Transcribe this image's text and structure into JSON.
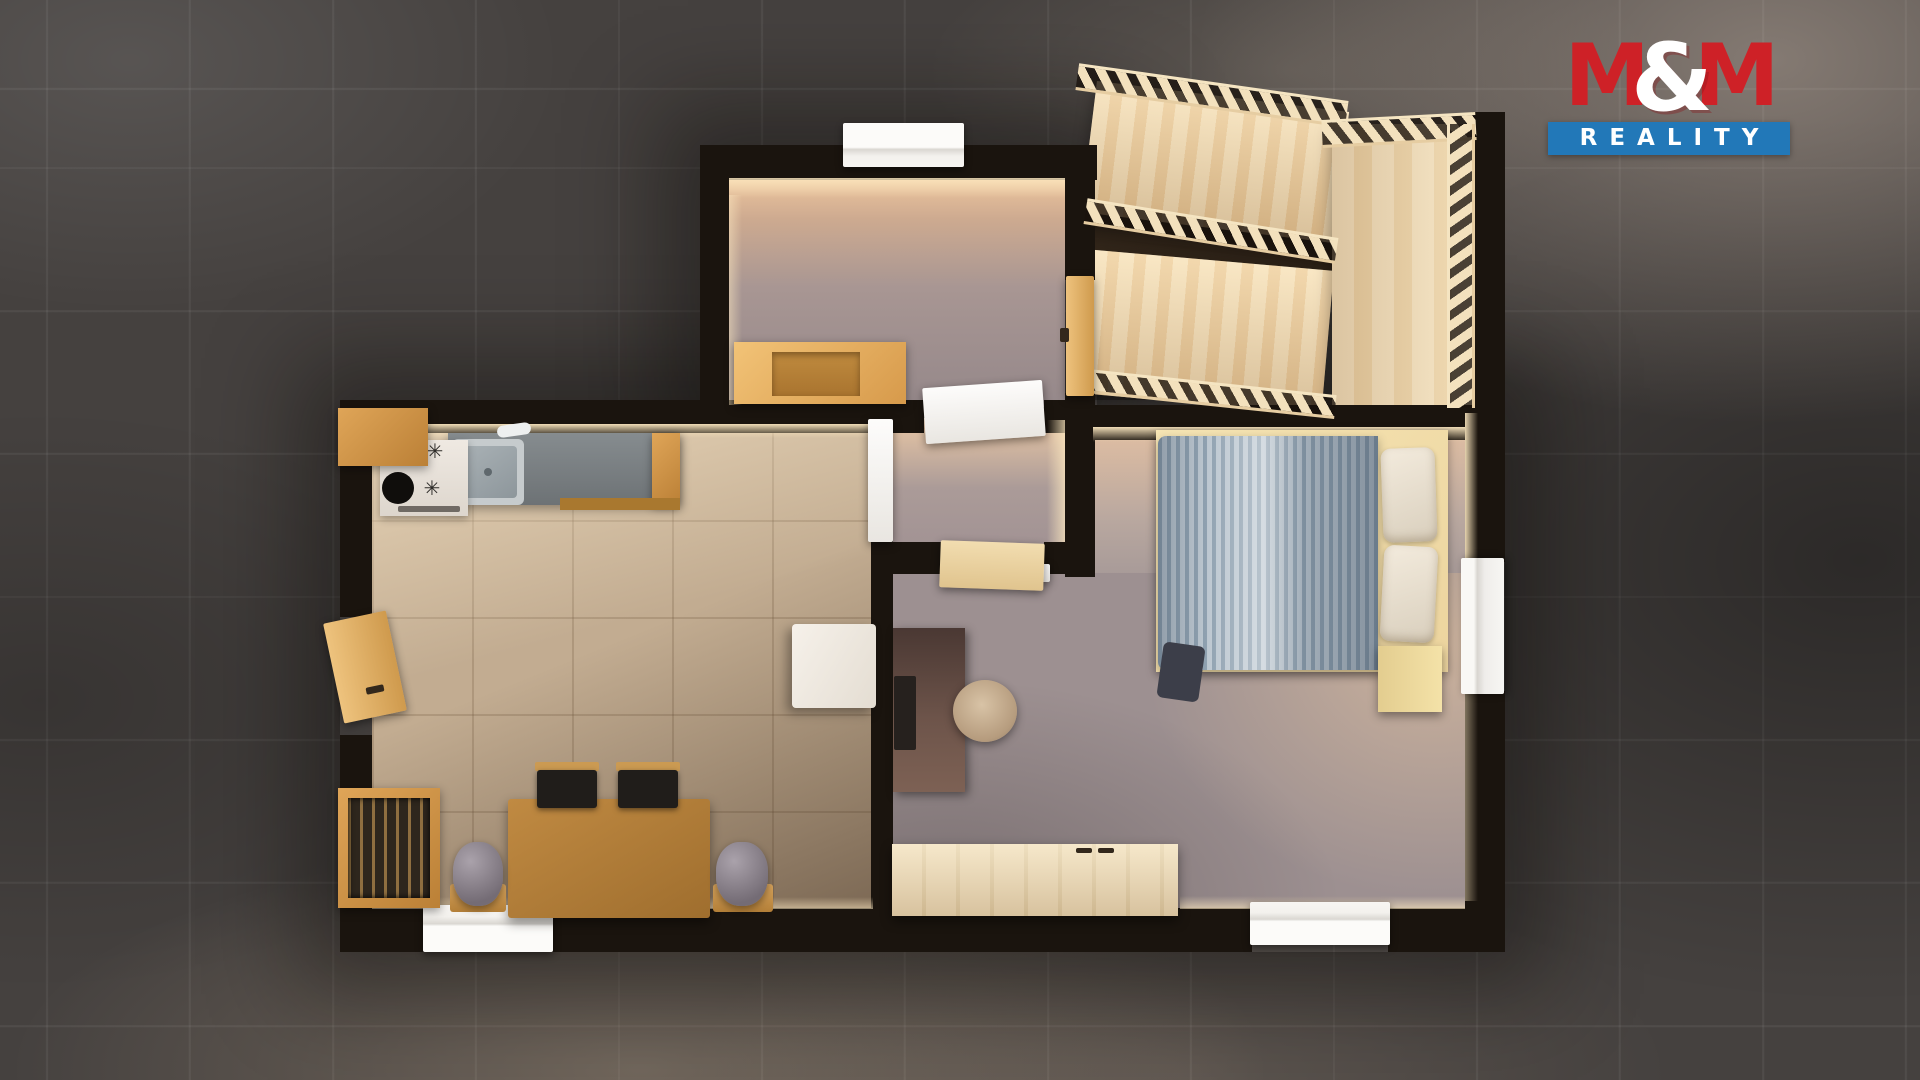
{
  "logo": {
    "m1": "M",
    "amp": "&",
    "m2": "M",
    "subtitle": "REALITY",
    "color_red": "#ce2127",
    "color_blue": "#2278b8",
    "text_color": "#ffffff"
  },
  "palette": {
    "background_tile": "#45413f",
    "wall": "#1a140e",
    "living_floor": "#c2ac91",
    "bedroom_floor": "#9d9091",
    "entry_floor": "#a89693",
    "stair_wood": "#f3e1bd",
    "furniture_wood": "#d79a4b",
    "duvet_blue": "#9fb0bd",
    "window_white": "#f7f5f2"
  },
  "scene": {
    "description": "3D top-down floor plan render: entry hall with bench, U-shaped staircase, kitchen-living room with dining set, hallway, bedroom with double bed, desk and sideboard",
    "items": [
      {
        "n": "shadow-halo-main",
        "c": "halo",
        "x": 340,
        "y": 400,
        "w": 1165,
        "h": 552
      },
      {
        "n": "shadow-halo-entry",
        "c": "halo",
        "x": 700,
        "y": 145,
        "w": 397,
        "h": 287
      },
      {
        "n": "entry-hall-floor",
        "c": "fl-entry",
        "x": 727,
        "y": 178,
        "w": 338,
        "h": 229
      },
      {
        "n": "living-room-floor",
        "c": "fl-living",
        "x": 372,
        "y": 432,
        "w": 501,
        "h": 478
      },
      {
        "n": "hallway-floor",
        "c": "fl-hall",
        "x": 893,
        "y": 418,
        "w": 172,
        "h": 127
      },
      {
        "n": "bedroom-floor-upper",
        "c": "fl-bed1",
        "x": 1093,
        "y": 438,
        "w": 372,
        "h": 140
      },
      {
        "n": "bedroom-floor-main",
        "c": "fl-bed2",
        "x": 893,
        "y": 573,
        "w": 572,
        "h": 337
      },
      {
        "n": "stair-gap-shadow",
        "c": "gapdark",
        "x": 1086,
        "y": 218,
        "w": 252,
        "h": 58,
        "r": 8
      },
      {
        "n": "stair-flight-upper",
        "c": "treads",
        "x": 1088,
        "y": 96,
        "w": 254,
        "h": 132,
        "r": 7
      },
      {
        "n": "stair-flight-lower",
        "c": "treads",
        "x": 1086,
        "y": 260,
        "w": 242,
        "h": 144,
        "r": 5
      },
      {
        "n": "stair-landing",
        "c": "treads2",
        "x": 1332,
        "y": 124,
        "w": 142,
        "h": 284
      },
      {
        "n": "wall-entry-top",
        "c": "wall",
        "x": 700,
        "y": 145,
        "w": 397,
        "h": 35
      },
      {
        "n": "wall-entry-left",
        "c": "wall",
        "x": 700,
        "y": 145,
        "w": 29,
        "h": 262
      },
      {
        "n": "wall-entry-right-upper",
        "c": "wall",
        "x": 1065,
        "y": 145,
        "w": 30,
        "h": 135
      },
      {
        "n": "wall-entry-right-lower",
        "c": "wall",
        "x": 1065,
        "y": 393,
        "w": 30,
        "h": 184
      },
      {
        "n": "wall-living-top-left",
        "c": "wall",
        "x": 340,
        "y": 400,
        "w": 584,
        "h": 33
      },
      {
        "n": "wall-living-top-right",
        "c": "wall",
        "x": 1044,
        "y": 400,
        "w": 33,
        "h": 33
      },
      {
        "n": "wall-bedroom-top",
        "c": "wall",
        "x": 1075,
        "y": 405,
        "w": 430,
        "h": 35
      },
      {
        "n": "wall-living-left-upper",
        "c": "wall",
        "x": 340,
        "y": 400,
        "w": 32,
        "h": 217
      },
      {
        "n": "wall-living-left-lower",
        "c": "wall",
        "x": 340,
        "y": 735,
        "w": 32,
        "h": 217
      },
      {
        "n": "wall-living-bottom-left",
        "c": "wall",
        "x": 340,
        "y": 908,
        "w": 85,
        "h": 44
      },
      {
        "n": "wall-living-bottom-right",
        "c": "wall",
        "x": 551,
        "y": 908,
        "w": 341,
        "h": 44
      },
      {
        "n": "wall-divider-top",
        "c": "wall",
        "x": 871,
        "y": 400,
        "w": 22,
        "h": 22
      },
      {
        "n": "wall-divider-lower",
        "c": "wall",
        "x": 871,
        "y": 540,
        "w": 22,
        "h": 368
      },
      {
        "n": "wall-hall-bottom-left",
        "c": "wall",
        "x": 893,
        "y": 542,
        "w": 49,
        "h": 32
      },
      {
        "n": "wall-hall-bottom-right",
        "c": "wall",
        "x": 1044,
        "y": 542,
        "w": 23,
        "h": 32
      },
      {
        "n": "wall-bedroom-right-upper",
        "c": "wall",
        "x": 1465,
        "y": 405,
        "w": 40,
        "h": 157
      },
      {
        "n": "wall-bedroom-right-lower",
        "c": "wall",
        "x": 1465,
        "y": 691,
        "w": 40,
        "h": 261
      },
      {
        "n": "wall-bedroom-bottom-left",
        "c": "wall",
        "x": 892,
        "y": 908,
        "w": 360,
        "h": 44
      },
      {
        "n": "wall-bedroom-bottom-right",
        "c": "wall",
        "x": 1388,
        "y": 908,
        "w": 117,
        "h": 44
      },
      {
        "n": "wall-staircase-right",
        "c": "wall",
        "x": 1472,
        "y": 112,
        "w": 33,
        "h": 296
      },
      {
        "n": "stair-railing-upper",
        "c": "rail",
        "x": 1076,
        "y": 82,
        "w": 272,
        "h": 27,
        "r": 8
      },
      {
        "n": "stair-railing-middle",
        "c": "rail",
        "x": 1084,
        "y": 218,
        "w": 254,
        "h": 26,
        "r": 9
      },
      {
        "n": "stair-railing-lower",
        "c": "rail",
        "x": 1086,
        "y": 382,
        "w": 250,
        "h": 24,
        "r": 6
      },
      {
        "n": "stair-railing-landing-top",
        "c": "rail",
        "x": 1322,
        "y": 116,
        "w": 154,
        "h": 28,
        "r": -3
      },
      {
        "n": "stair-railing-landing-right",
        "c": "railv",
        "x": 1447,
        "y": 124,
        "w": 28,
        "h": 284
      },
      {
        "n": "wall-glow-living-top",
        "c": "cream",
        "x": 372,
        "y": 424,
        "w": 501,
        "h": 14
      },
      {
        "n": "wall-glow-bedroom-top",
        "c": "cream",
        "x": 1093,
        "y": 427,
        "w": 372,
        "h": 15
      },
      {
        "n": "wall-glow-entry-top",
        "c": "cream",
        "x": 729,
        "y": 178,
        "w": 336,
        "h": 20,
        "o": 0.9
      },
      {
        "n": "wall-glow-entry-left",
        "c": "creamv",
        "x": 729,
        "y": 195,
        "w": 13,
        "h": 210,
        "o": 0.55
      },
      {
        "n": "wall-glow-bedroom-right-upper",
        "c": "creamv",
        "x": 1465,
        "y": 413,
        "w": 13,
        "h": 152
      },
      {
        "n": "wall-glow-bedroom-right-lower",
        "c": "creamv",
        "x": 1465,
        "y": 691,
        "w": 13,
        "h": 210,
        "o": 0.5
      },
      {
        "n": "wall-glow-living-bottom",
        "c": "creamup",
        "x": 372,
        "y": 897,
        "w": 501,
        "h": 12,
        "o": 0.7
      },
      {
        "n": "wall-glow-bedroom-bottom",
        "c": "creamup",
        "x": 1180,
        "y": 896,
        "w": 285,
        "h": 13,
        "o": 0.8
      },
      {
        "n": "wall-glow-hall-right",
        "c": "creamvr",
        "x": 1047,
        "y": 420,
        "w": 18,
        "h": 122,
        "o": 0.8
      },
      {
        "n": "window-entry-top",
        "c": "win-h",
        "x": 843,
        "y": 123,
        "w": 121,
        "h": 44
      },
      {
        "n": "window-living-bottom",
        "c": "win-hup",
        "x": 423,
        "y": 905,
        "w": 130,
        "h": 47
      },
      {
        "n": "window-bedroom-bottom",
        "c": "win-hup",
        "x": 1250,
        "y": 902,
        "w": 140,
        "h": 43
      },
      {
        "n": "window-bedroom-right",
        "c": "win-v",
        "x": 1461,
        "y": 558,
        "w": 43,
        "h": 136
      },
      {
        "n": "door-white-entry-hall",
        "c": "leafw",
        "x": 924,
        "y": 384,
        "w": 120,
        "h": 56,
        "r": -4
      },
      {
        "n": "door-white-living-hall",
        "c": "leafw",
        "x": 868,
        "y": 419,
        "w": 25,
        "h": 123
      },
      {
        "n": "door-frame-white-hall",
        "c": "leafw",
        "x": 1028,
        "y": 564,
        "w": 22,
        "h": 18
      },
      {
        "n": "door-wood-hall-bedroom",
        "c": "doorpale",
        "x": 940,
        "y": 542,
        "w": 104,
        "h": 47,
        "r": 2
      },
      {
        "n": "door-wood-staircase",
        "c": "doorwood",
        "x": 1066,
        "y": 276,
        "w": 28,
        "h": 120
      },
      {
        "n": "door-handle-staircase",
        "c": "handle",
        "x": 1060,
        "y": 328,
        "w": 9,
        "h": 14
      },
      {
        "n": "door-wood-living-entrance",
        "c": "doorwood",
        "x": 333,
        "y": 616,
        "w": 64,
        "h": 102,
        "r": -12
      },
      {
        "n": "door-handle-living",
        "c": "handle",
        "x": 366,
        "y": 686,
        "w": 18,
        "h": 7,
        "r": -12
      },
      {
        "n": "kitchen-counter",
        "c": "counter",
        "x": 448,
        "y": 433,
        "w": 232,
        "h": 72
      },
      {
        "n": "kitchen-counter-wood-end",
        "c": "wd2",
        "x": 652,
        "y": 433,
        "w": 28,
        "h": 72
      },
      {
        "n": "kitchen-drawer-front",
        "c": "wd3",
        "x": 560,
        "y": 498,
        "w": 120,
        "h": 12
      },
      {
        "n": "kitchen-sink",
        "c": "sinkout",
        "x": 452,
        "y": 439,
        "w": 72,
        "h": 66
      },
      {
        "n": "kitchen-sink-basin",
        "c": "sinkin",
        "x": 459,
        "y": 446,
        "w": 58,
        "h": 52
      },
      {
        "n": "kitchen-sink-drain",
        "c": "dot",
        "x": 484,
        "y": 468,
        "w": 8,
        "h": 8
      },
      {
        "n": "kitchen-faucet",
        "c": "faucet",
        "x": 497,
        "y": 424,
        "w": 34,
        "h": 12,
        "r": -8
      },
      {
        "n": "kitchen-stove",
        "c": "stove",
        "x": 380,
        "y": 440,
        "w": 88,
        "h": 76
      },
      {
        "n": "stove-plate",
        "c": "blackcirc",
        "x": 382,
        "y": 472,
        "w": 32,
        "h": 32
      },
      {
        "n": "stove-burner-icon-1",
        "c": "burner",
        "x": 424,
        "y": 440,
        "w": 22,
        "h": 22,
        "t": "✳"
      },
      {
        "n": "stove-burner-icon-2",
        "c": "burner",
        "x": 420,
        "y": 476,
        "w": 24,
        "h": 24,
        "t": "✳"
      },
      {
        "n": "oven-vent-line",
        "c": "ovenline",
        "x": 398,
        "y": 506,
        "w": 62,
        "h": 6
      },
      {
        "n": "kitchen-cabinet-corner",
        "c": "wd2",
        "x": 338,
        "y": 408,
        "w": 90,
        "h": 58
      },
      {
        "n": "entry-bench",
        "c": "wd1",
        "x": 734,
        "y": 342,
        "w": 172,
        "h": 62
      },
      {
        "n": "entry-bench-seat",
        "c": "benchseat",
        "x": 772,
        "y": 352,
        "w": 88,
        "h": 44
      },
      {
        "n": "display-cabinet",
        "c": "wd2",
        "x": 338,
        "y": 788,
        "w": 102,
        "h": 120
      },
      {
        "n": "display-cabinet-glass",
        "c": "cabin",
        "x": 348,
        "y": 798,
        "w": 82,
        "h": 100
      },
      {
        "n": "dining-table",
        "c": "tbl",
        "x": 508,
        "y": 799,
        "w": 202,
        "h": 119
      },
      {
        "n": "dining-chair-1-backrail",
        "c": "chairbar",
        "x": 535,
        "y": 762,
        "w": 64,
        "h": 9
      },
      {
        "n": "dining-chair-1",
        "c": "chairblk",
        "x": 537,
        "y": 770,
        "w": 60,
        "h": 38
      },
      {
        "n": "dining-chair-2-backrail",
        "c": "chairbar",
        "x": 616,
        "y": 762,
        "w": 64,
        "h": 9
      },
      {
        "n": "dining-chair-2",
        "c": "chairblk",
        "x": 618,
        "y": 770,
        "w": 60,
        "h": 38
      },
      {
        "n": "plant-stool-left",
        "c": "stool",
        "x": 450,
        "y": 884,
        "w": 56,
        "h": 28
      },
      {
        "n": "plant-pot-left",
        "c": "bin",
        "x": 453,
        "y": 842,
        "w": 50,
        "h": 64
      },
      {
        "n": "plant-stool-right",
        "c": "stool",
        "x": 713,
        "y": 884,
        "w": 60,
        "h": 28
      },
      {
        "n": "plant-pot-right",
        "c": "bin",
        "x": 716,
        "y": 842,
        "w": 52,
        "h": 64
      },
      {
        "n": "white-armchair",
        "c": "sofa",
        "x": 792,
        "y": 624,
        "w": 84,
        "h": 84
      },
      {
        "n": "bed-frame",
        "c": "pale",
        "x": 1156,
        "y": 430,
        "w": 292,
        "h": 242
      },
      {
        "n": "bed-duvet",
        "c": "duvet",
        "x": 1158,
        "y": 436,
        "w": 220,
        "h": 234
      },
      {
        "n": "bed-pillow-top",
        "c": "pillow",
        "x": 1382,
        "y": 448,
        "w": 54,
        "h": 94,
        "r": -2
      },
      {
        "n": "bed-pillow-bottom",
        "c": "pillow",
        "x": 1382,
        "y": 546,
        "w": 54,
        "h": 96,
        "r": 3
      },
      {
        "n": "bed-blanket-fold",
        "c": "fold",
        "x": 1160,
        "y": 644,
        "w": 42,
        "h": 56,
        "r": 8
      },
      {
        "n": "nightstand",
        "c": "nstand",
        "x": 1378,
        "y": 646,
        "w": 64,
        "h": 66
      },
      {
        "n": "desk",
        "c": "desk",
        "x": 893,
        "y": 628,
        "w": 72,
        "h": 164
      },
      {
        "n": "desk-monitor",
        "c": "monitor",
        "x": 894,
        "y": 676,
        "w": 22,
        "h": 74
      },
      {
        "n": "office-chair",
        "c": "ochair",
        "x": 953,
        "y": 680,
        "w": 64,
        "h": 62
      },
      {
        "n": "sideboard",
        "c": "sideboard",
        "x": 892,
        "y": 844,
        "w": 286,
        "h": 72
      },
      {
        "n": "sideboard-handle-1",
        "c": "handle",
        "x": 1076,
        "y": 848,
        "w": 16,
        "h": 5
      },
      {
        "n": "sideboard-handle-2",
        "c": "handle",
        "x": 1098,
        "y": 848,
        "w": 16,
        "h": 5
      }
    ]
  }
}
